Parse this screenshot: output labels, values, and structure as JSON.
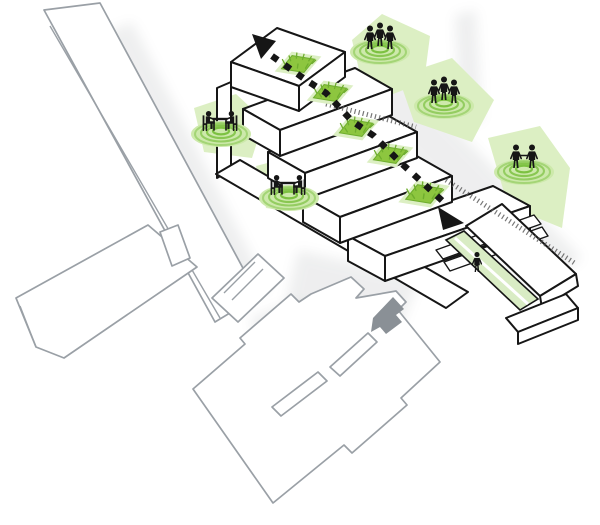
{
  "diagram": {
    "kind": "architectural-concept-axonometric",
    "palette_note": "white volumes, black proposal outlines, gray context outlines, green activity accents"
  },
  "palette": {
    "background": "#ffffff",
    "context_outline": "#9aa0a6",
    "building_outline": "#161616",
    "people": "#161616",
    "green_accent": "#8dc63f",
    "green_grass_dark": "#6fae2e",
    "green_ripple": "#7cc141",
    "green_blob": "#dcefc3",
    "green_pad": "#cde9ab",
    "green_walkway": "#d9ecc4",
    "entry_arrow_gray": "#8a9096"
  },
  "elements": {
    "context_buildings": 2,
    "stepped_bars": 5,
    "green_terraces": 5,
    "courtyard_openings": 2
  },
  "icons": [
    {
      "name": "people-seated-table-icon",
      "count": 2
    },
    {
      "name": "people-trio-standing-icon",
      "count": 2
    },
    {
      "name": "people-handshake-icon",
      "count": 1
    },
    {
      "name": "person-walking-icon",
      "count": 1
    },
    {
      "name": "path-arrow-up-icon",
      "count": 1
    },
    {
      "name": "path-arrow-down-icon",
      "count": 1
    },
    {
      "name": "entry-arrow-icon",
      "count": 1
    }
  ]
}
